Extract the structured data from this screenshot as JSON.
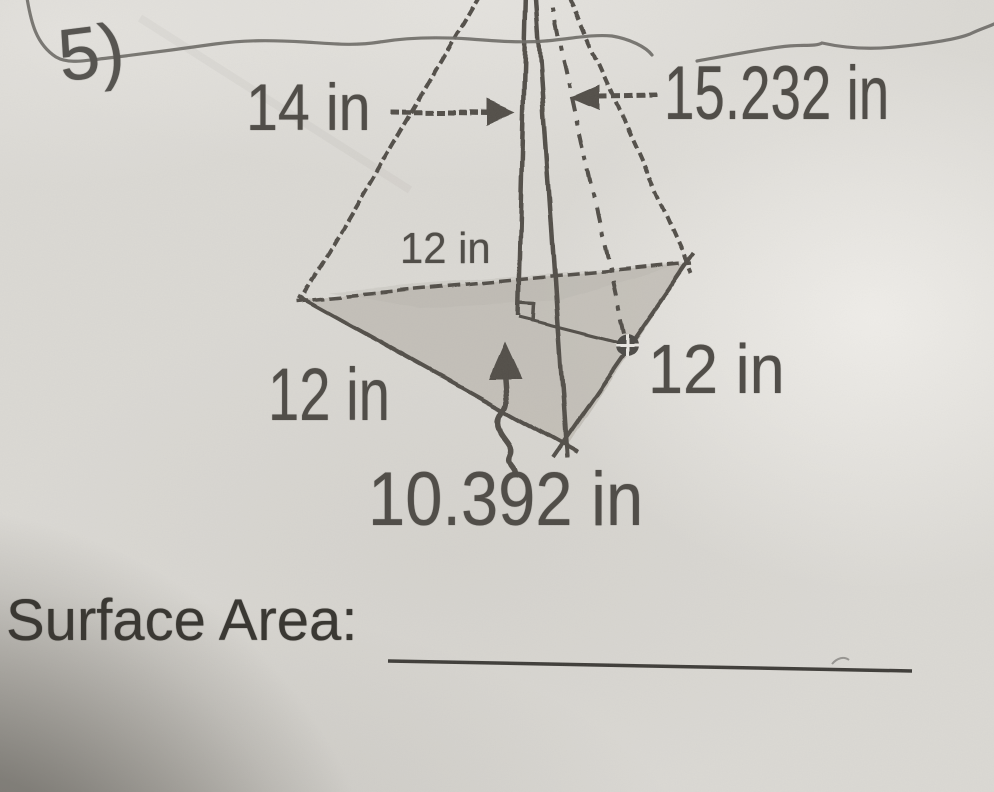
{
  "problem": {
    "number": "5)"
  },
  "figure_labels": {
    "pyramid_height": "14 in",
    "slant_height": "15.232 in",
    "base_edge_top": "12 in",
    "base_edge_left": "12 in",
    "base_edge_right": "12 in",
    "base_triangle_height": "10.392 in"
  },
  "answer": {
    "label": "Surface Area:"
  },
  "colors": {
    "paper": "#dad8d3",
    "print_ink": "#514e49",
    "pencil_shade": "#bcb8b1",
    "pen_stroke": "#6f6d68",
    "answer_line": "#3f3d39"
  }
}
